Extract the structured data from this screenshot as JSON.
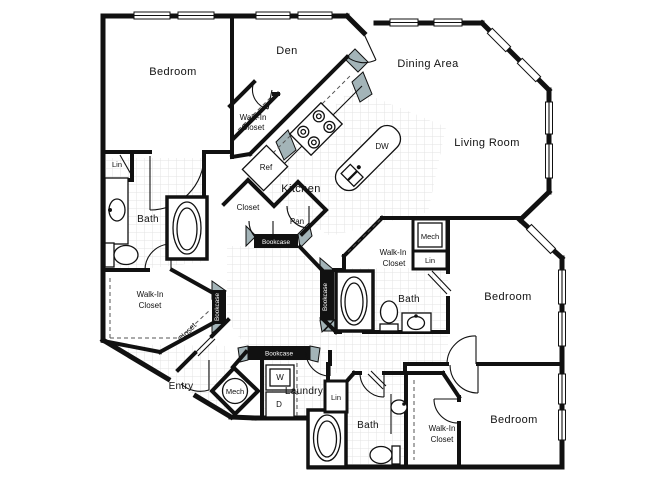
{
  "plan": {
    "type": "apartment-floor-plan",
    "colors": {
      "wall": "#111111",
      "shade": "#a3b4b8",
      "tile_line": "#e3e3e3",
      "floor": "#ffffff"
    },
    "labels": {
      "bedroom_tl": "Bedroom",
      "den": "Den",
      "dining": "Dining Area",
      "living": "Living Room",
      "wic_top_1": "Walk-In",
      "wic_top_2": "Closet",
      "ref": "Ref",
      "kitchen": "Kitchen",
      "dw": "DW",
      "closet_mid": "Closet",
      "pan": "Pan",
      "bc_kitchen": "Bookcase",
      "lin_left": "Lin",
      "bath_left": "Bath",
      "wic_left_1": "Walk-In",
      "wic_left_2": "Closet",
      "bc_hall_left": "Bookcase",
      "closet_diag": "Closet",
      "entry": "Entry",
      "mech_entry": "Mech",
      "bc_laundry": "Bookcase",
      "washer": "W",
      "dryer": "D",
      "laundry": "Laundry",
      "lin_bottom": "Lin",
      "bath_bottom": "Bath",
      "wic_bottom_1": "Walk-In",
      "wic_bottom_2": "Closet",
      "bedroom_br": "Bedroom",
      "bedroom_mr": "Bedroom",
      "wic_mid_1": "Walk-In",
      "wic_mid_2": "Closet",
      "mech_mid": "Mech",
      "lin_mid": "Lin",
      "bath_mid": "Bath",
      "bc_hall_right": "Bookcase"
    }
  }
}
